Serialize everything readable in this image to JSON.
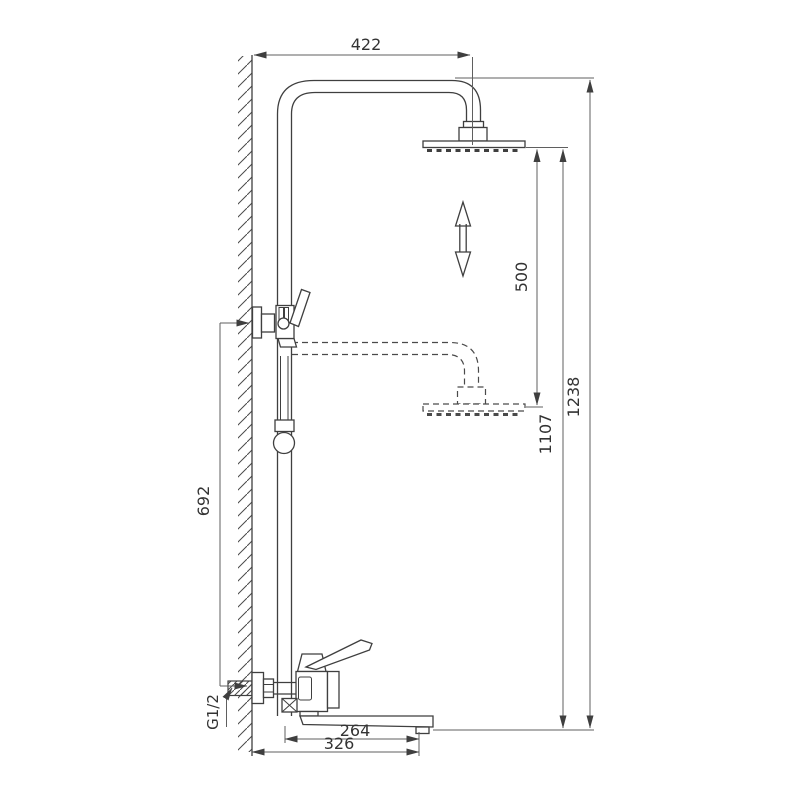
{
  "title": "shower-system-technical-drawing",
  "dimensions": {
    "top_arm_width": "422",
    "shower_head_travel": "500",
    "lower_height": "1107",
    "total_height": "1238",
    "wall_bracket_spacing": "692",
    "spout_reach": "264",
    "spout_overall_reach": "326"
  },
  "thread_size": "G1/2",
  "colors": {
    "part_line": "#3f3f3f",
    "dimension_line": "#5f5f5f",
    "text": "#333333",
    "background": "#ffffff"
  },
  "icons": {
    "height_adjust": "double-vertical-arrow"
  }
}
